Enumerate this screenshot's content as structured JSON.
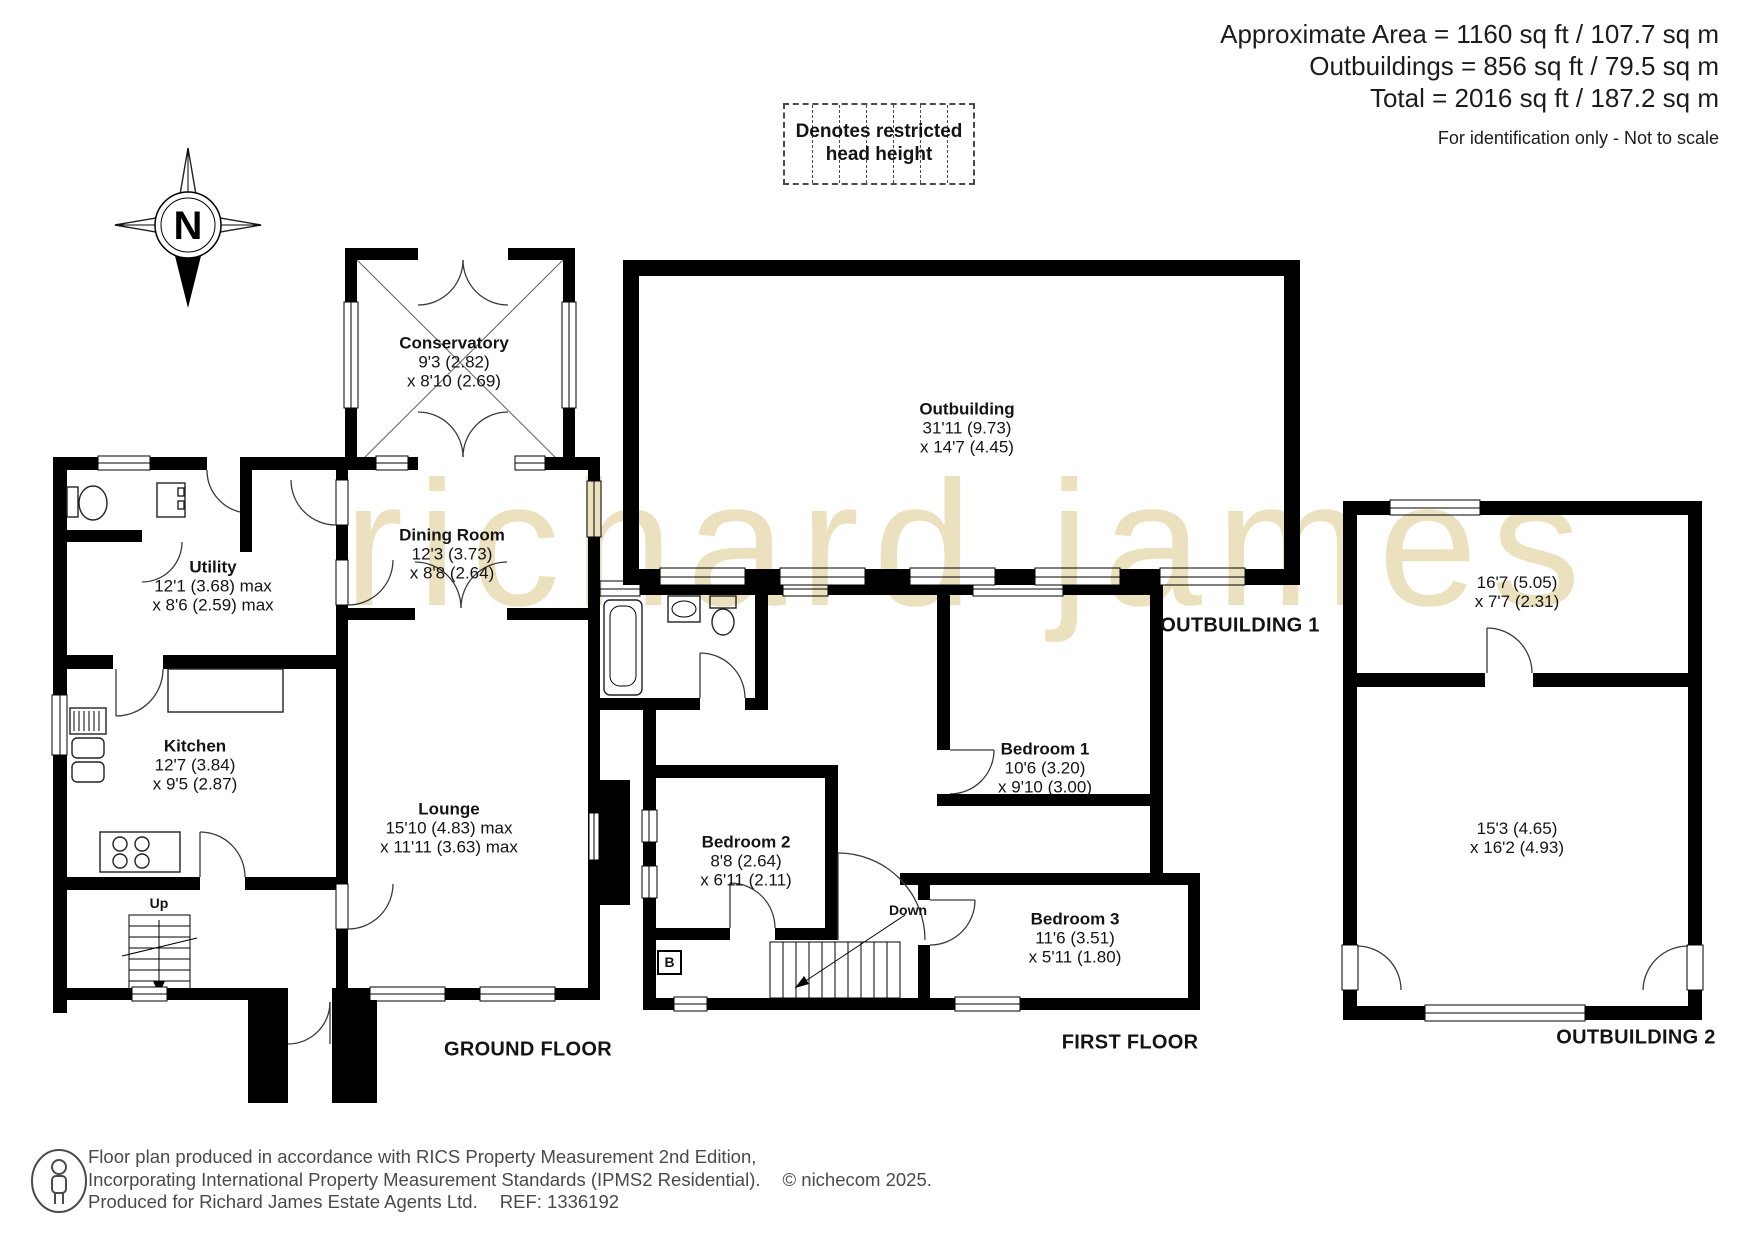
{
  "header": {
    "area_line1": "Approximate Area = 1160 sq ft / 107.7 sq m",
    "area_line2": "Outbuildings = 856 sq ft / 79.5 sq m",
    "area_line3": "Total = 2016 sq ft / 187.2 sq m",
    "disclaimer": "For identification only - Not to scale"
  },
  "legend": {
    "restricted_line1": "Denotes restricted",
    "restricted_line2": "head height"
  },
  "compass": {
    "north_label": "N"
  },
  "watermark": "richard james",
  "floors": {
    "ground": {
      "title": "GROUND FLOOR",
      "stairs_label": "Up",
      "rooms": {
        "conservatory": {
          "name": "Conservatory",
          "dim1": "9'3 (2.82)",
          "dim2": "x 8'10 (2.69)"
        },
        "dining_room": {
          "name": "Dining Room",
          "dim1": "12'3 (3.73)",
          "dim2": "x 8'8 (2.64)"
        },
        "utility": {
          "name": "Utility",
          "dim1": "12'1 (3.68) max",
          "dim2": "x 8'6 (2.59) max"
        },
        "kitchen": {
          "name": "Kitchen",
          "dim1": "12'7 (3.84)",
          "dim2": "x 9'5 (2.87)"
        },
        "lounge": {
          "name": "Lounge",
          "dim1": "15'10 (4.83) max",
          "dim2": "x 11'11 (3.63) max"
        }
      }
    },
    "first": {
      "title": "FIRST FLOOR",
      "stairs_label": "Down",
      "boiler_label": "B",
      "rooms": {
        "bedroom1": {
          "name": "Bedroom 1",
          "dim1": "10'6 (3.20)",
          "dim2": "x 9'10 (3.00)"
        },
        "bedroom2": {
          "name": "Bedroom 2",
          "dim1": "8'8 (2.64)",
          "dim2": "x 6'11 (2.11)"
        },
        "bedroom3": {
          "name": "Bedroom 3",
          "dim1": "11'6 (3.51)",
          "dim2": "x 5'11 (1.80)"
        }
      }
    },
    "outbuilding1": {
      "title": "OUTBUILDING 1",
      "rooms": {
        "outbuilding": {
          "name": "Outbuilding",
          "dim1": "31'11 (9.73)",
          "dim2": "x 14'7 (4.45)"
        }
      }
    },
    "outbuilding2": {
      "title": "OUTBUILDING 2",
      "rooms": {
        "room1": {
          "dim1": "16'7 (5.05)",
          "dim2": "x 7'7 (2.31)"
        },
        "room2": {
          "dim1": "15'3 (4.65)",
          "dim2": "x 16'2 (4.93)"
        }
      }
    }
  },
  "footer": {
    "line1": "Floor plan produced in accordance with RICS Property Measurement 2nd Edition,",
    "line2": "Incorporating International Property Measurement Standards (IPMS2 Residential).",
    "copyright": "© nichecom 2025.",
    "line3": "Produced for Richard James Estate Agents Ltd.",
    "ref": "REF: 1336192"
  },
  "colors": {
    "wall": "#000000",
    "watermark": "#ece1bf",
    "footer_text": "#4a4a4a"
  }
}
